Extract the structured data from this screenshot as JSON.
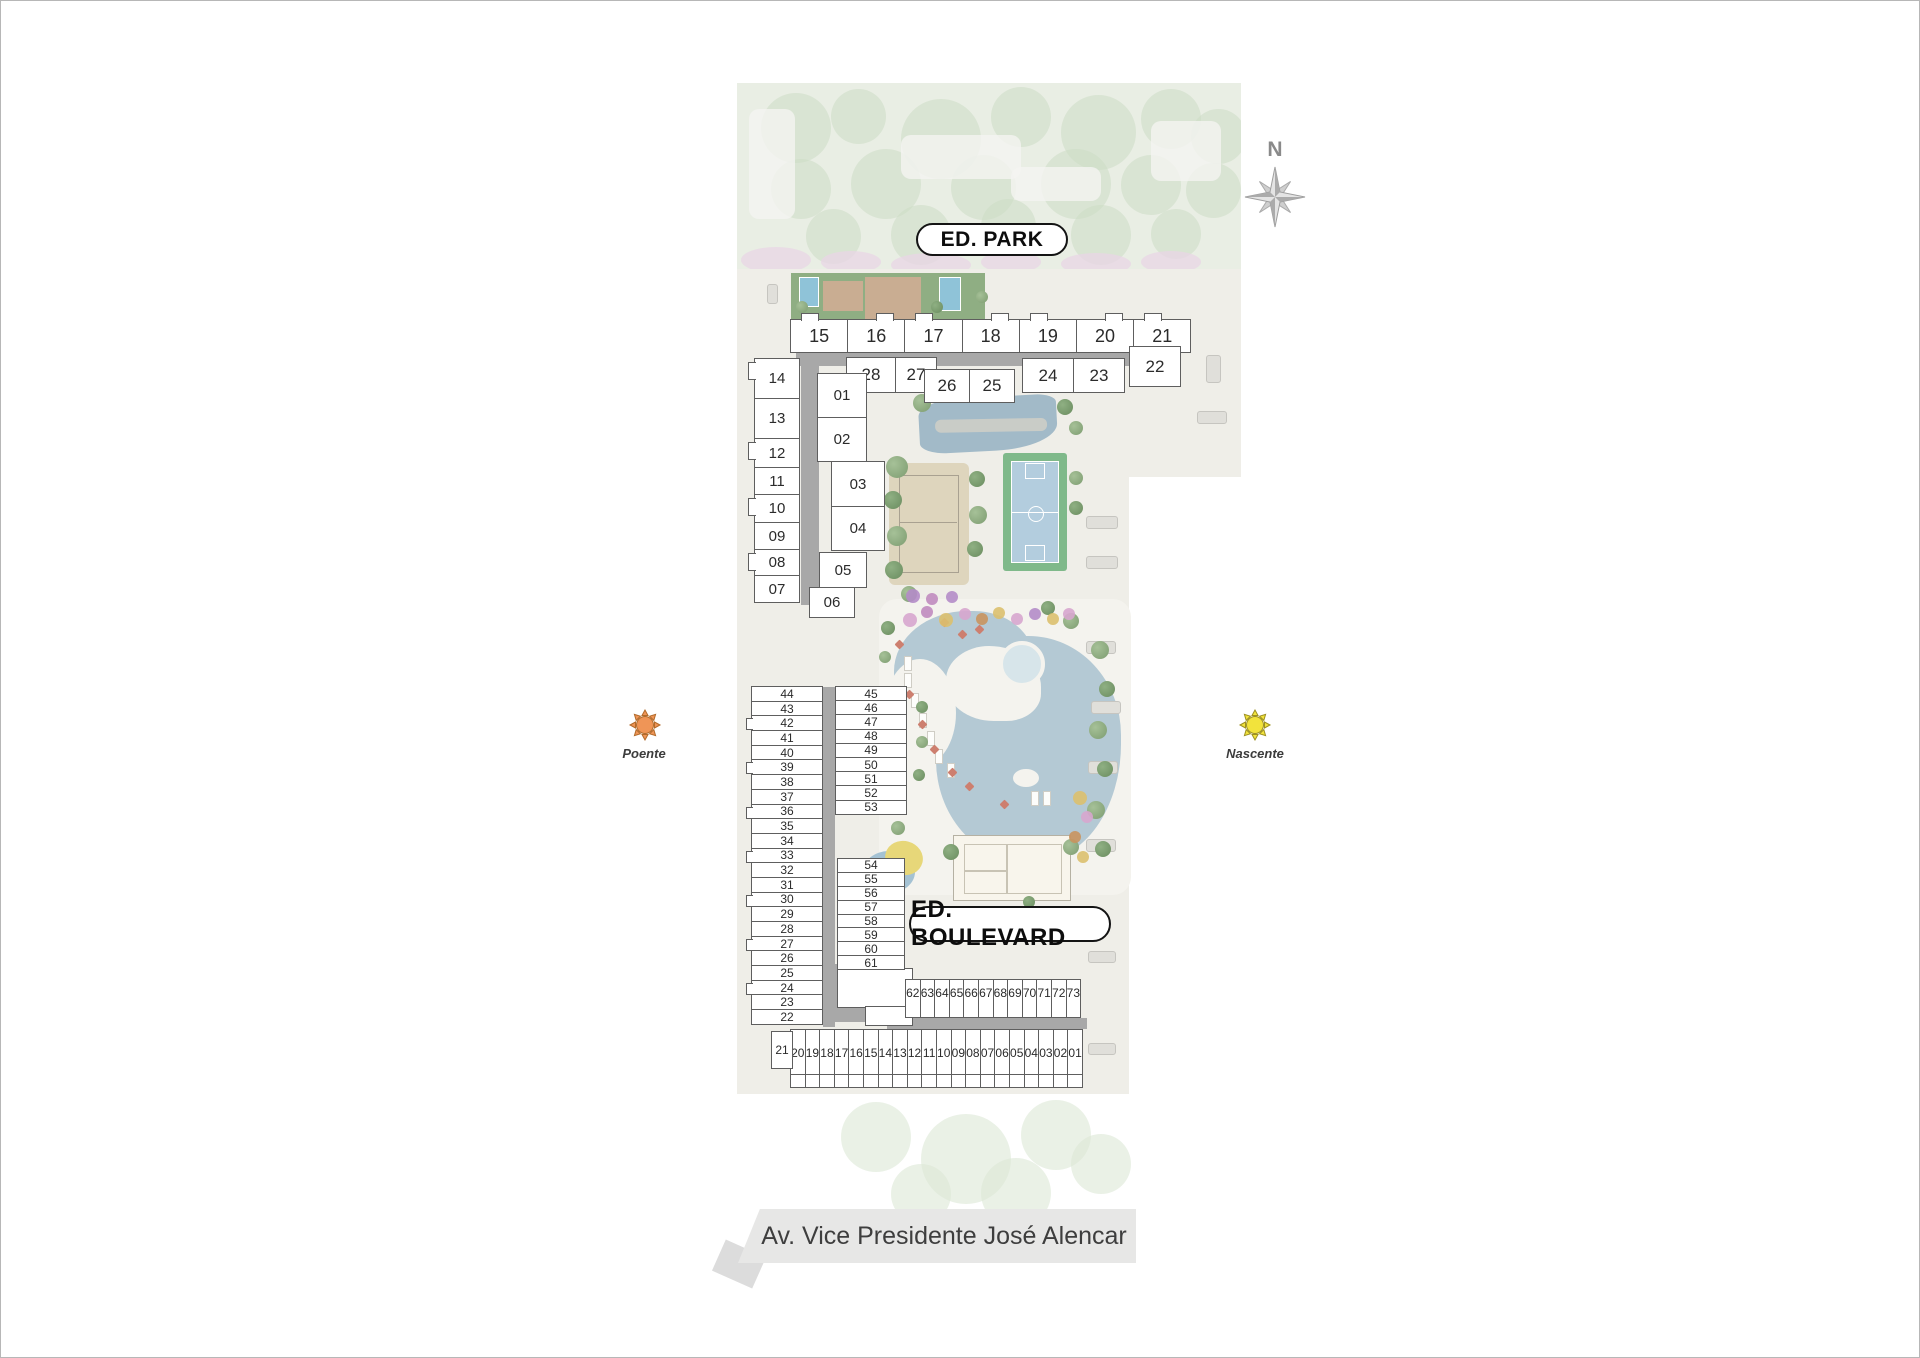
{
  "compass": {
    "north_label": "N"
  },
  "buildings": {
    "park": {
      "label": "ED. PARK",
      "top_row": [
        "15",
        "16",
        "17",
        "18",
        "19",
        "20",
        "21"
      ],
      "second_row_a": [
        "28",
        "27"
      ],
      "second_row_b": [
        "26",
        "25"
      ],
      "second_row_c": [
        "24",
        "23"
      ],
      "unit_22": "22",
      "west_column_outer": [
        "14",
        "13",
        "12",
        "11",
        "10",
        "09",
        "08",
        "07"
      ],
      "west_column_inner": [
        "01",
        "02",
        "03",
        "04",
        "05",
        "06"
      ]
    },
    "boulevard": {
      "label": "ED. BOULEVARD",
      "unit_21": "21",
      "west_column_outer": [
        "44",
        "43",
        "42",
        "41",
        "40",
        "39",
        "38",
        "37",
        "36",
        "35",
        "34",
        "33",
        "32",
        "31",
        "30",
        "29",
        "28",
        "27",
        "26",
        "25",
        "24",
        "23",
        "22"
      ],
      "west_column_inner_upper": [
        "45",
        "46",
        "47",
        "48",
        "49",
        "50",
        "51",
        "52",
        "53"
      ],
      "west_column_inner_lower": [
        "54",
        "55",
        "56",
        "57",
        "58",
        "59",
        "60",
        "61"
      ],
      "south_row_upper": [
        "62",
        "63",
        "64",
        "65",
        "66",
        "67",
        "68",
        "69",
        "70",
        "71",
        "72",
        "73"
      ],
      "south_row_lower": [
        "20",
        "19",
        "18",
        "17",
        "16",
        "15",
        "14",
        "13",
        "12",
        "11",
        "10",
        "09",
        "08",
        "07",
        "06",
        "05",
        "04",
        "03",
        "02",
        "01"
      ]
    }
  },
  "orientation": {
    "west_label": "Poente",
    "east_label": "Nascente"
  },
  "street": {
    "name": "Av. Vice Presidente José Alencar"
  },
  "colors": {
    "corridor_gray": "#a8a8a8",
    "unit_border": "#5e5e5e",
    "pool_blue": "#b4c9d4",
    "court_green": "#7fb98a",
    "court_blue": "#b3cdde",
    "sand": "#ded5bd",
    "sun_west": "#ef9557",
    "sun_east": "#f2e33c"
  }
}
